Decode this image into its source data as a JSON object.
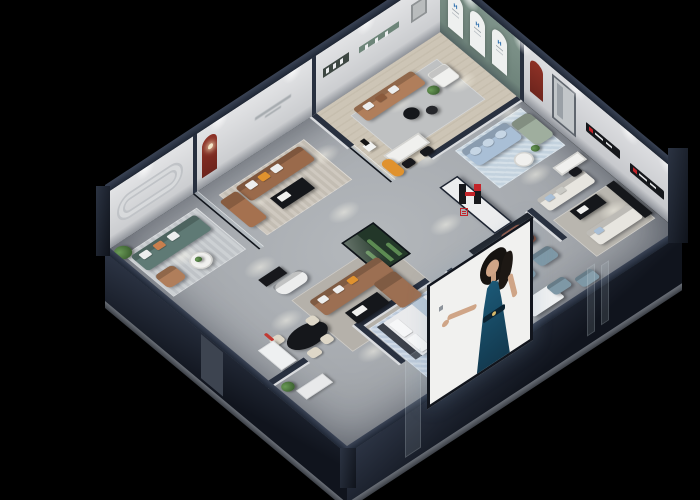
{
  "meta": {
    "type": "3d-isometric-showroom-render",
    "description": "Cutaway dollhouse view of a furniture brand showroom at night on a black background",
    "canvas": {
      "width": 700,
      "height": 500,
      "background": "#000000"
    }
  },
  "brand": {
    "glyph": "H",
    "name_cn": "华悦",
    "logo_red": "#c3242a",
    "logo_dark": "#17181c",
    "appearances": [
      "entry pier wall",
      "bedroom wall sign",
      "back wall media ledges",
      "arched window badges"
    ]
  },
  "palette": {
    "navy": "#28303f",
    "cap": "#1f2735",
    "wallFace": "#d8d9db",
    "wallGreen": "#7e938a",
    "archRed": "#8e3126",
    "floor": "#aab0b4",
    "floorWood": "#cdc5b6",
    "sofaBrown": "#9a6a4b",
    "sofaTan": "#b07e5b",
    "sofaTeal": "#5f7a75",
    "sofaBlue": "#a9bfd6",
    "sofaSage": "#9fae9e",
    "sofaCream": "#e7e5df",
    "sofaSlate": "#7e98a6",
    "accentOrange": "#e0922e",
    "accentTerracotta": "#b4674f",
    "tableBlack": "#15171b",
    "rugBlue": "#b9c8d8",
    "plant": "#4e7a42",
    "posterBg": "#f1f1ef",
    "posterDress": "#1c5a78",
    "logoRed": "#c3242a"
  },
  "rooms": [
    {
      "name": "teal lounge",
      "position": "back-left",
      "furniture": [
        "teal three-seat sofa with white and orange pillows",
        "tan armchair",
        "white round coffee table",
        "striped grey rug",
        "potted plant"
      ],
      "wall_feature": "rounded-rectangle wall moulding"
    },
    {
      "name": "brown sofa lounge",
      "position": "back-centre-left",
      "furniture": [
        "brown leather three-seat sofa",
        "terracotta loveseat",
        "black coffee table with white tray",
        "striped warm rug"
      ],
      "wall_feature": "red arched niche with lamp, small illegible wall tagline, black-framed glass partition"
    },
    {
      "name": "top corner lounge",
      "position": "top-corner",
      "floor": "light wood",
      "furniture": [
        "tan leather sofa",
        "white armchair",
        "two black round side tables",
        "grey rug",
        "plant",
        "sculpture on white pedestal",
        "white desk with two black chairs",
        "orange curved bench"
      ],
      "wall_feature": "sage green wall with three white arched windows carrying small blue brand badges, recessed display ledge"
    },
    {
      "name": "blue lounge",
      "position": "right-upper",
      "furniture": [
        "light-blue pillowed sofa",
        "sage chaise",
        "white round table",
        "plant",
        "pale blue rug"
      ]
    },
    {
      "name": "central gallery",
      "position": "centre",
      "furniture": [
        "brown L-sectional sofa",
        "black coffee table with white tray",
        "white curved settee",
        "glass terrarium with cacti",
        "black oval dining table with cream chairs",
        "red floor lamp",
        "white display shelf",
        "black sideboard"
      ]
    },
    {
      "name": "entry lounge",
      "position": "centre-front",
      "furniture": [
        "white pier wall with brand logo",
        "terracotta high-back chair",
        "two slate-blue armchairs",
        "slate ottoman",
        "black round table",
        "black media wall"
      ]
    },
    {
      "name": "bedroom",
      "position": "front-left",
      "furniture": [
        "white bed with blue throw",
        "black bedside bench",
        "patterned blue rug",
        "long black media console",
        "black round rug with swivel chair",
        "white daybed",
        "white cabinet",
        "plant"
      ]
    },
    {
      "name": "cream lounge",
      "position": "front-right",
      "furniture": [
        "two cream sofas with blue pillows",
        "black coffee table",
        "white desk with black chair",
        "black media console",
        "grey rug",
        "two slate ottomans"
      ],
      "wall_feature": "red arched niche, grey door panel, black media ledges with brand marks"
    }
  ],
  "poster": {
    "type": "storefront lightbox panel",
    "content": "illustrated woman in a dark blue halter evening dress, arm extended",
    "side_text": "vertical column of small characters (illegible)"
  },
  "exterior": {
    "walls": "dark navy cutaway slabs with grey plinth",
    "corner_columns": 2,
    "wall_caps": "dark navy"
  },
  "lighting": {
    "spotlights": "warm white downlight pools across the floor and scalloped glows on back walls"
  }
}
